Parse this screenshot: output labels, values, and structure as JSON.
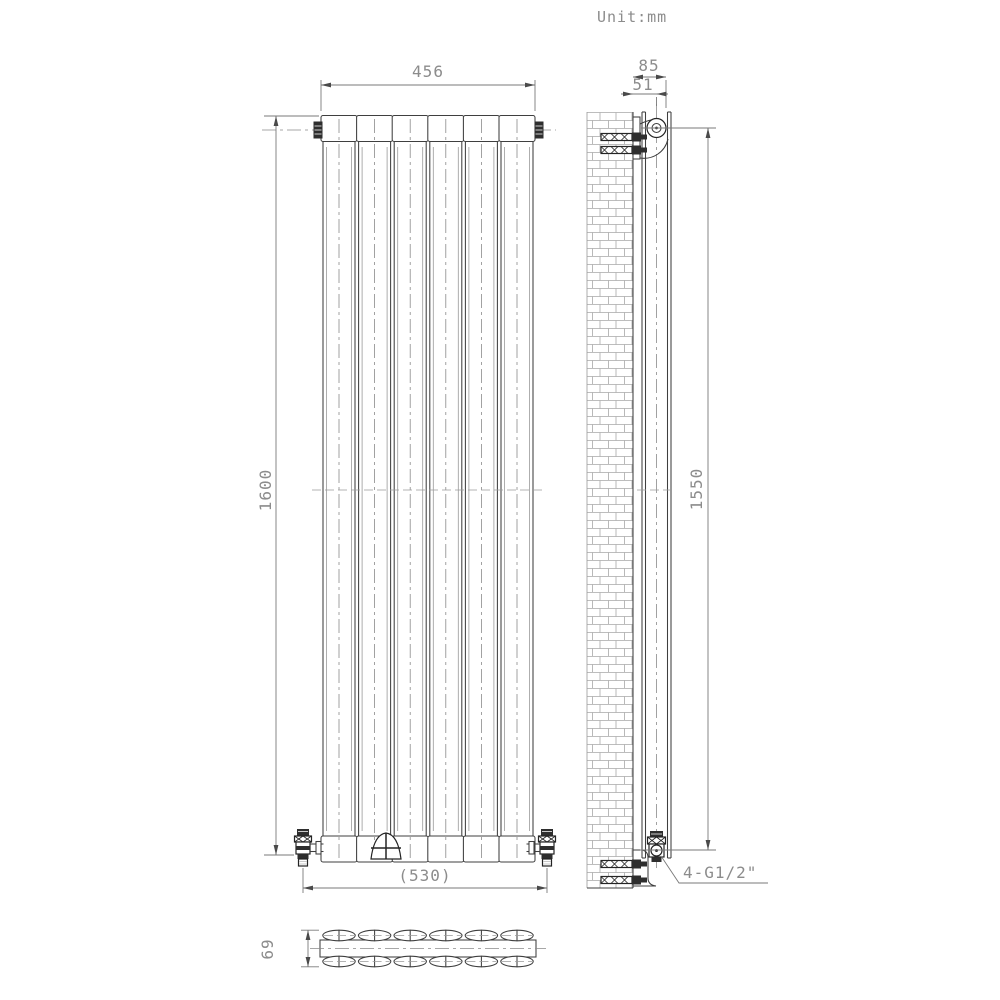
{
  "title": {
    "unit_label": "Unit:mm"
  },
  "views": {
    "front": {
      "description": "front elevation of vertical flat-panel radiator",
      "panel_count": 6,
      "dims": {
        "width": "456",
        "height": "1600",
        "valve_spacing": "(530)"
      }
    },
    "side": {
      "description": "side section against brick wall with mounting brackets",
      "dims": {
        "total_depth": "85",
        "wall_to_center": "51",
        "bracket_height": "1550"
      },
      "connection_label": "4-G1/2\""
    },
    "section": {
      "description": "plan cross-section of double oval-tube panel",
      "oval_count": 12,
      "dims": {
        "depth": "69"
      }
    }
  },
  "colors": {
    "background": "#ffffff",
    "line": "#3f3f3f",
    "dimension": "#7a7a7a",
    "text": "#8c8c8c"
  }
}
